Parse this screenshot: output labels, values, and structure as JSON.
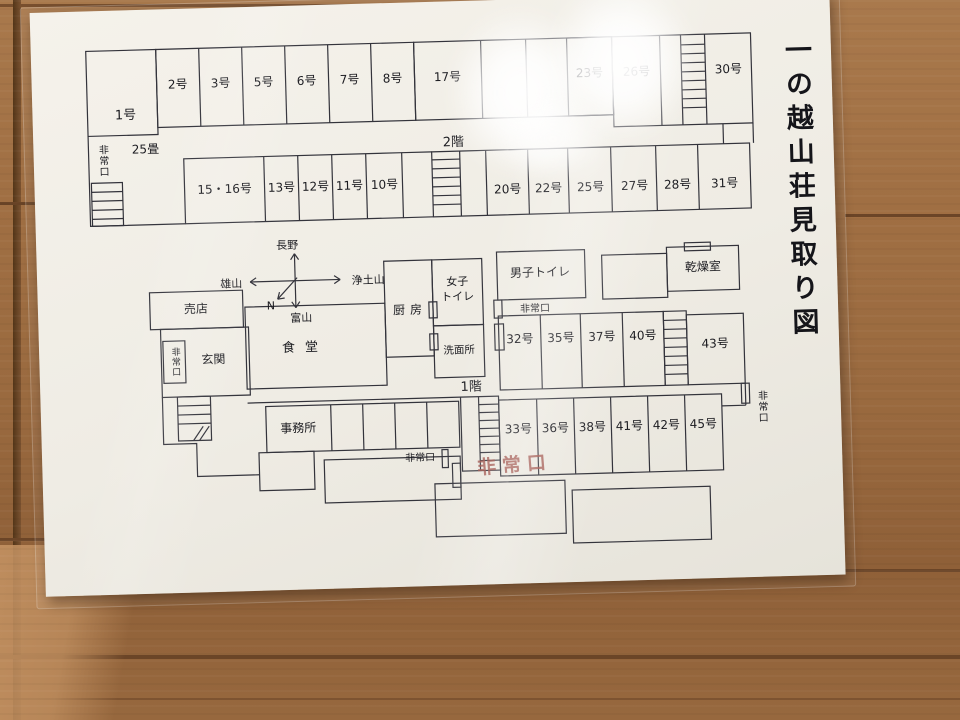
{
  "paper": {
    "title": "一の越山荘見取り図",
    "floor2": {
      "label": "2階",
      "room_1": "1号",
      "room_1_size": "25畳",
      "west_exit": "非常口",
      "top_row": [
        "2号",
        "3号",
        "5号",
        "6号",
        "7号",
        "8号",
        "17号"
      ],
      "highlighted_room": "23号",
      "room_26": "26号",
      "room_30": "30号",
      "lower_left_row": [
        "15・16号",
        "13号",
        "12号",
        "11号",
        "10号"
      ],
      "lower_right_row": [
        "20号",
        "22号",
        "25号",
        "27号",
        "28号",
        "31号"
      ]
    },
    "compass": {
      "north_label": "N",
      "up": "長野",
      "right": "浄土山",
      "left": "雄山",
      "down": "富山"
    },
    "floor1": {
      "label": "1階",
      "shop": "売店",
      "entrance": "玄関",
      "entrance_exit": "非常口",
      "dining": "食堂",
      "kitchen": "厨房",
      "women_toilet_lines": [
        "女子",
        "トイレ"
      ],
      "men_toilet": "男子トイレ",
      "mid_exit": "非常口",
      "washroom": "洗面所",
      "drying_room": "乾燥室",
      "mid_row": [
        "32号",
        "35号",
        "37号",
        "40号"
      ],
      "room_43": "43号",
      "east_exit": "非常口",
      "office": "事務所",
      "bottom_row": [
        "33号",
        "36号",
        "38号",
        "41号",
        "42号",
        "45号"
      ],
      "south_exit": "非常口",
      "south_exit_red": "非常口"
    },
    "highlight_color": "#efb3ad",
    "red_text_color": "#9e4f47"
  }
}
